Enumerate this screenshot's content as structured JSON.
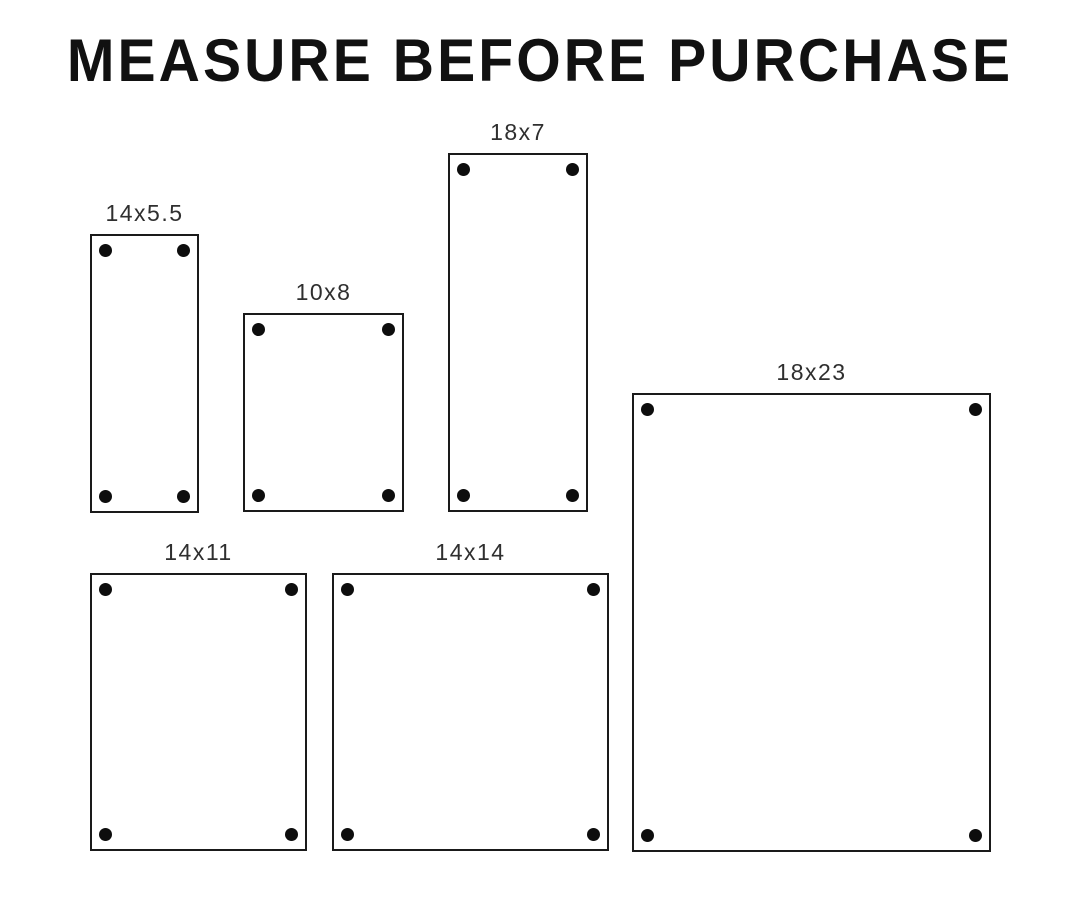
{
  "title": "MEASURE BEFORE PURCHASE",
  "colors": {
    "background": "#ffffff",
    "title": "#111111",
    "label": "#2f2f2f",
    "outline": "#1a1a1a",
    "hole": "#0d0d0d"
  },
  "holes_per_panel": 4,
  "panels": [
    {
      "label": "14x5.5",
      "x": 90,
      "y": 234,
      "w": 109,
      "h": 279
    },
    {
      "label": "10x8",
      "x": 243,
      "y": 313,
      "w": 161,
      "h": 199
    },
    {
      "label": "18x7",
      "x": 448,
      "y": 153,
      "w": 140,
      "h": 359
    },
    {
      "label": "18x23",
      "x": 632,
      "y": 393,
      "w": 359,
      "h": 459
    },
    {
      "label": "14x11",
      "x": 90,
      "y": 573,
      "w": 217,
      "h": 278
    },
    {
      "label": "14x14",
      "x": 332,
      "y": 573,
      "w": 277,
      "h": 278
    }
  ]
}
